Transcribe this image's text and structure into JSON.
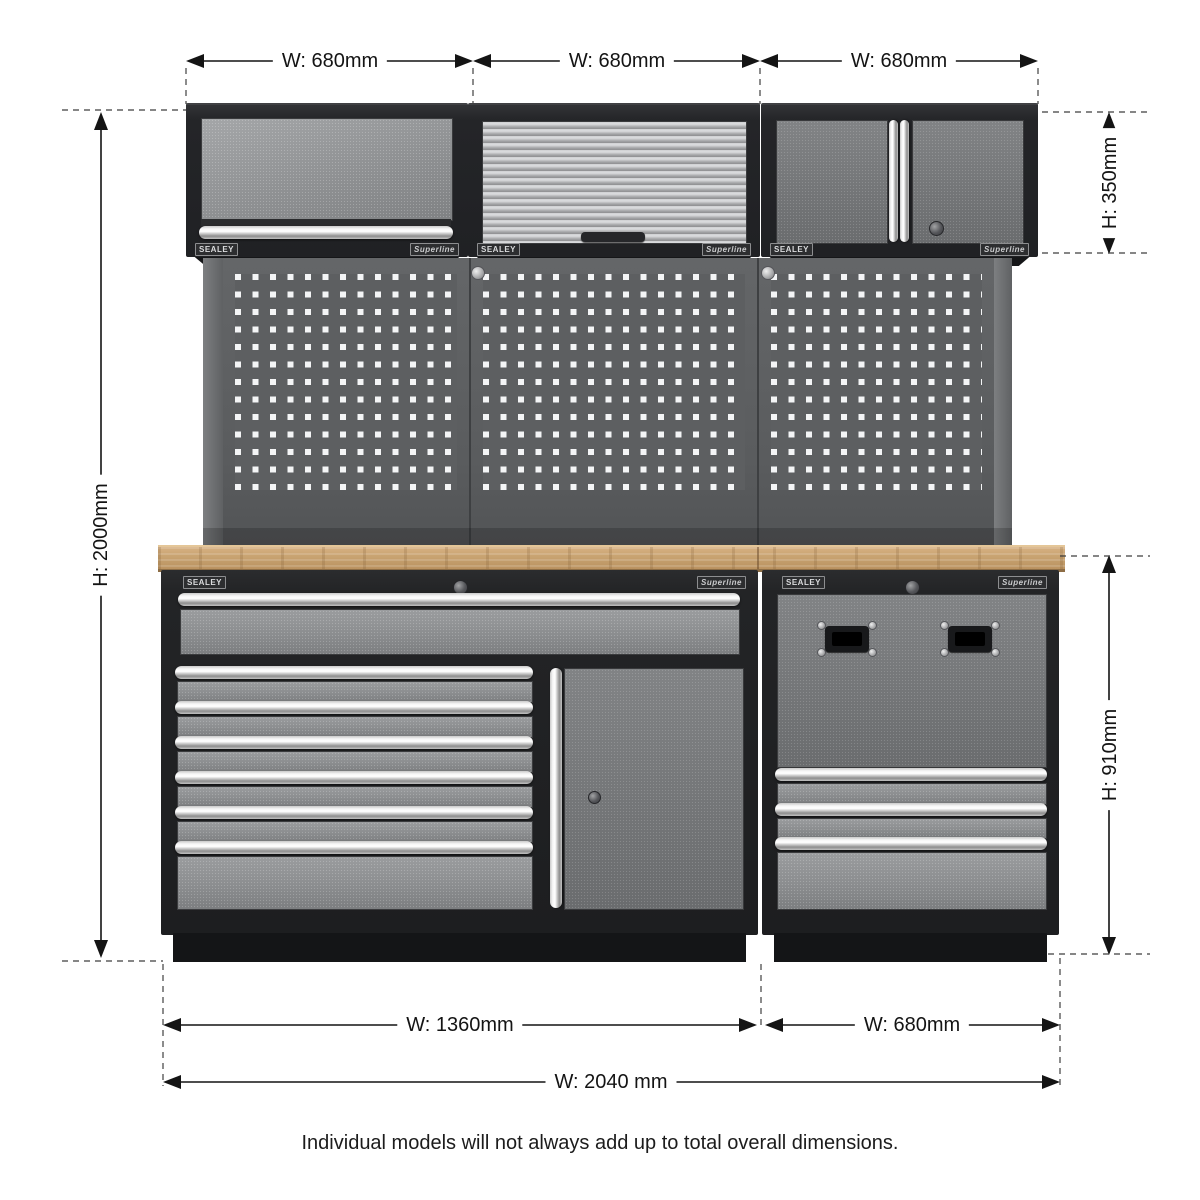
{
  "annotations": {
    "top_widths": [
      "W: 680mm",
      "W: 680mm",
      "W: 680mm"
    ],
    "overall_height": "H: 2000mm",
    "wall_cabinet_height": "H: 350mm",
    "base_unit_height": "H: 910mm",
    "base_left_width": "W: 1360mm",
    "base_right_width": "W: 680mm",
    "overall_width": "W: 2040 mm"
  },
  "branding": {
    "sealey": "SEALEY",
    "superline": "Superline"
  },
  "footnote": "Individual models will not always add up to total overall dimensions.",
  "colors": {
    "background": "#ffffff",
    "frame_black": "#232427",
    "panel_grey": "#8b8d8f",
    "pegboard_grey": "#5d5f61",
    "worktop_wood": "#c9a472",
    "chrome": "#e8e8e8",
    "plinth_black": "#141517",
    "dimension_text": "#141414"
  }
}
